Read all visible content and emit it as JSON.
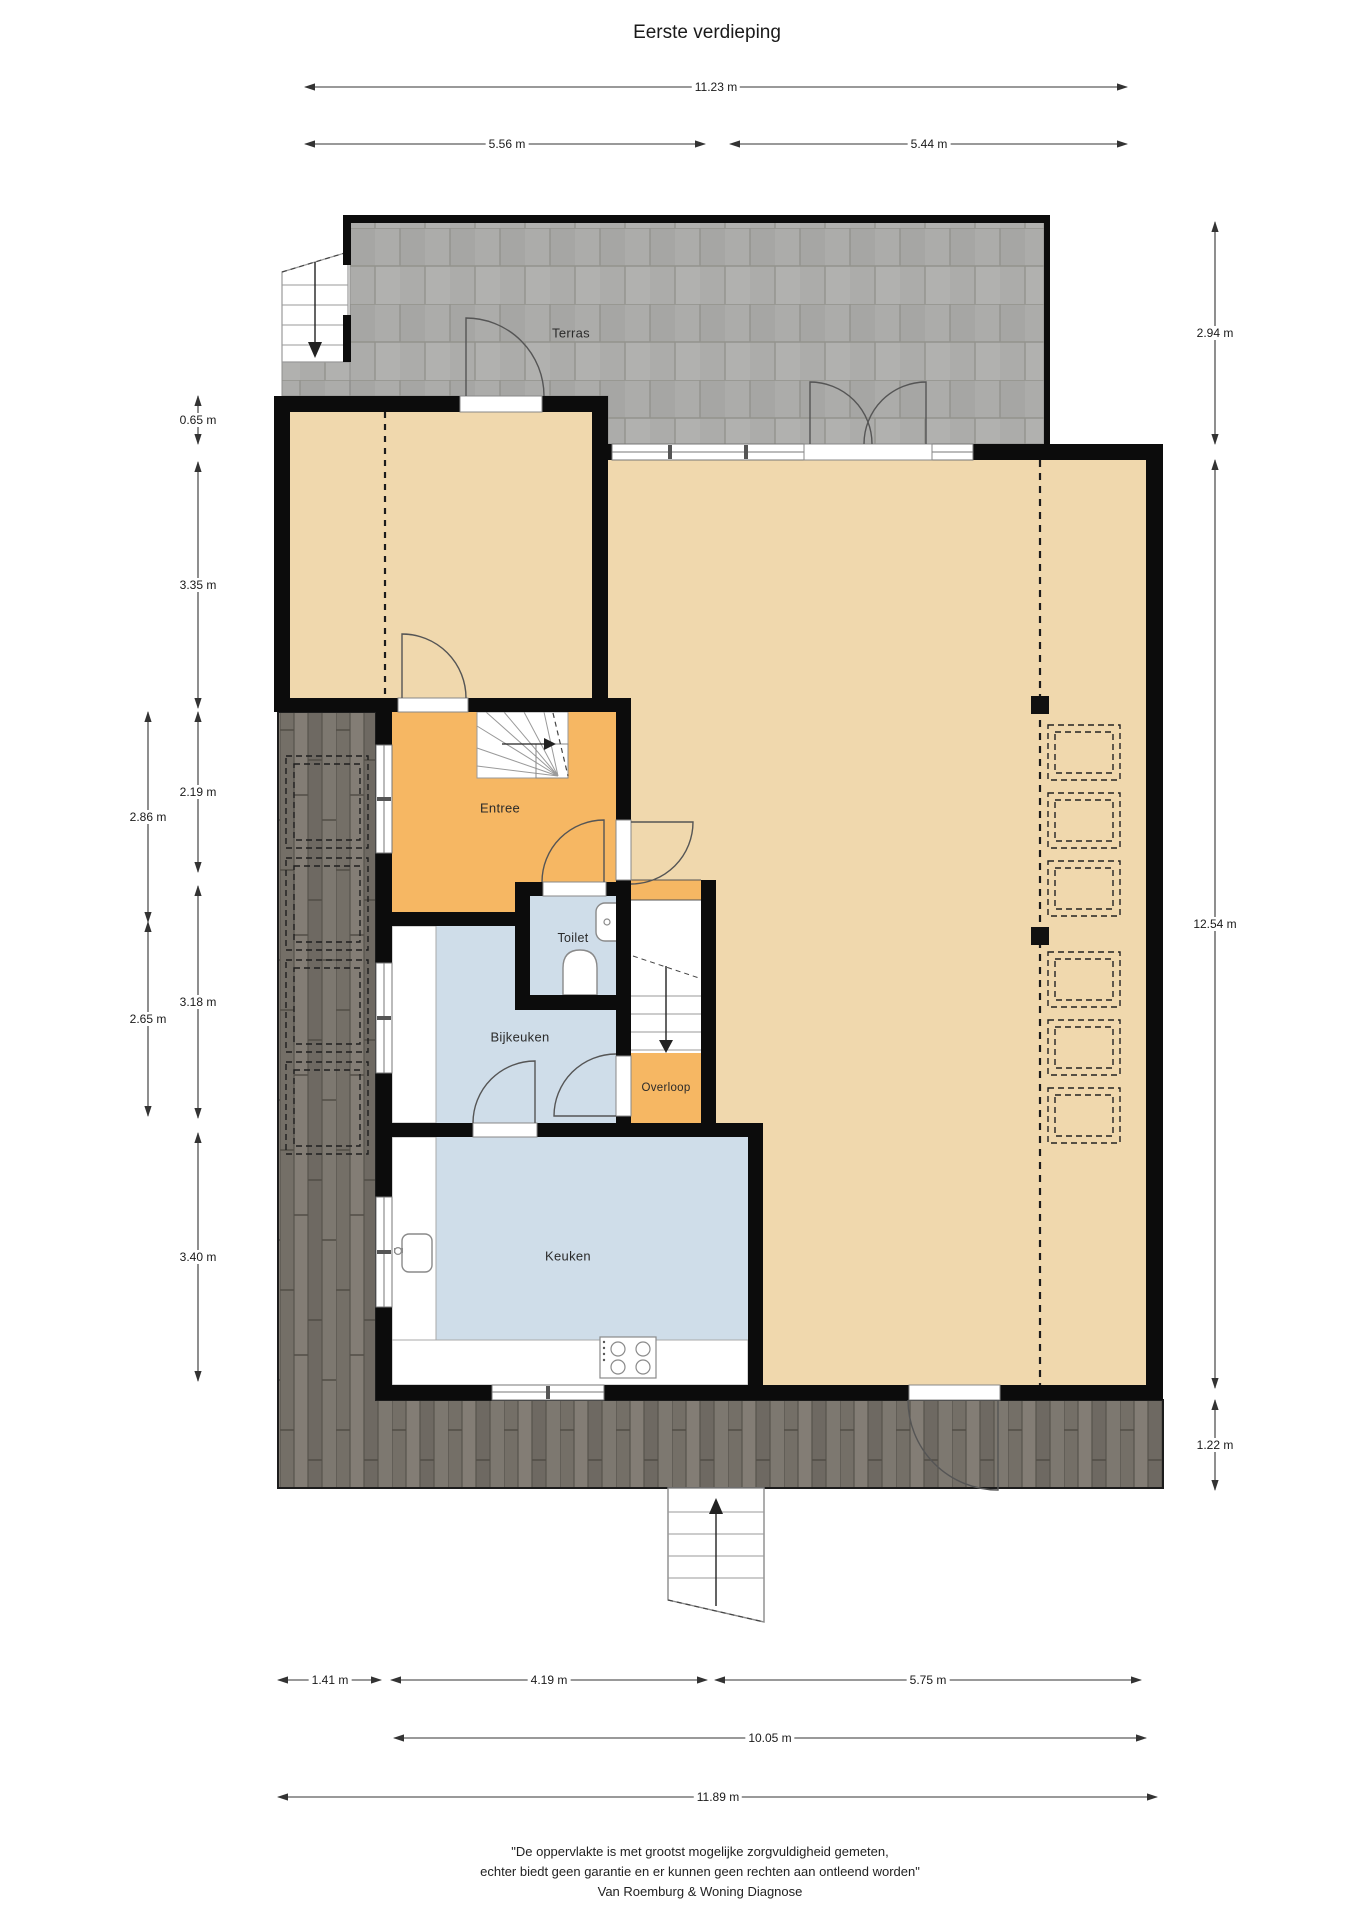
{
  "title": "Eerste verdieping",
  "rooms": {
    "terras": "Terras",
    "entree": "Entree",
    "toilet": "Toilet",
    "bijkeuken": "Bijkeuken",
    "overloop": "Overloop",
    "keuken": "Keuken"
  },
  "dimensions": {
    "top": [
      "11.23 m",
      "5.56 m",
      "5.44 m"
    ],
    "left_inner": [
      "0.65 m",
      "3.35 m",
      "2.19 m",
      "3.18 m",
      "3.40 m"
    ],
    "left_outer": [
      "2.86 m",
      "2.65 m"
    ],
    "right": [
      "2.94 m",
      "12.54 m",
      "1.22 m"
    ],
    "bottom_row1": [
      "1.41 m",
      "4.19 m",
      "5.75 m"
    ],
    "bottom_row2": [
      "10.05 m"
    ],
    "bottom_row3": [
      "11.89 m"
    ]
  },
  "footer": {
    "line1": "\"De oppervlakte is met grootst mogelijke zorgvuldigheid gemeten,",
    "line2": "echter biedt geen garantie en er kunnen geen rechten aan ontleend worden\"",
    "line3": "Van Roemburg & Woning Diagnose"
  },
  "colors": {
    "wall": "#0c0c0c",
    "room_beige": "#f0d8ad",
    "room_orange": "#f6b763",
    "room_blue": "#cfdde9",
    "terrace_tile": "#acacaa",
    "deck_wood": "#7b766e",
    "dimension_text": "#1a1a1a"
  }
}
